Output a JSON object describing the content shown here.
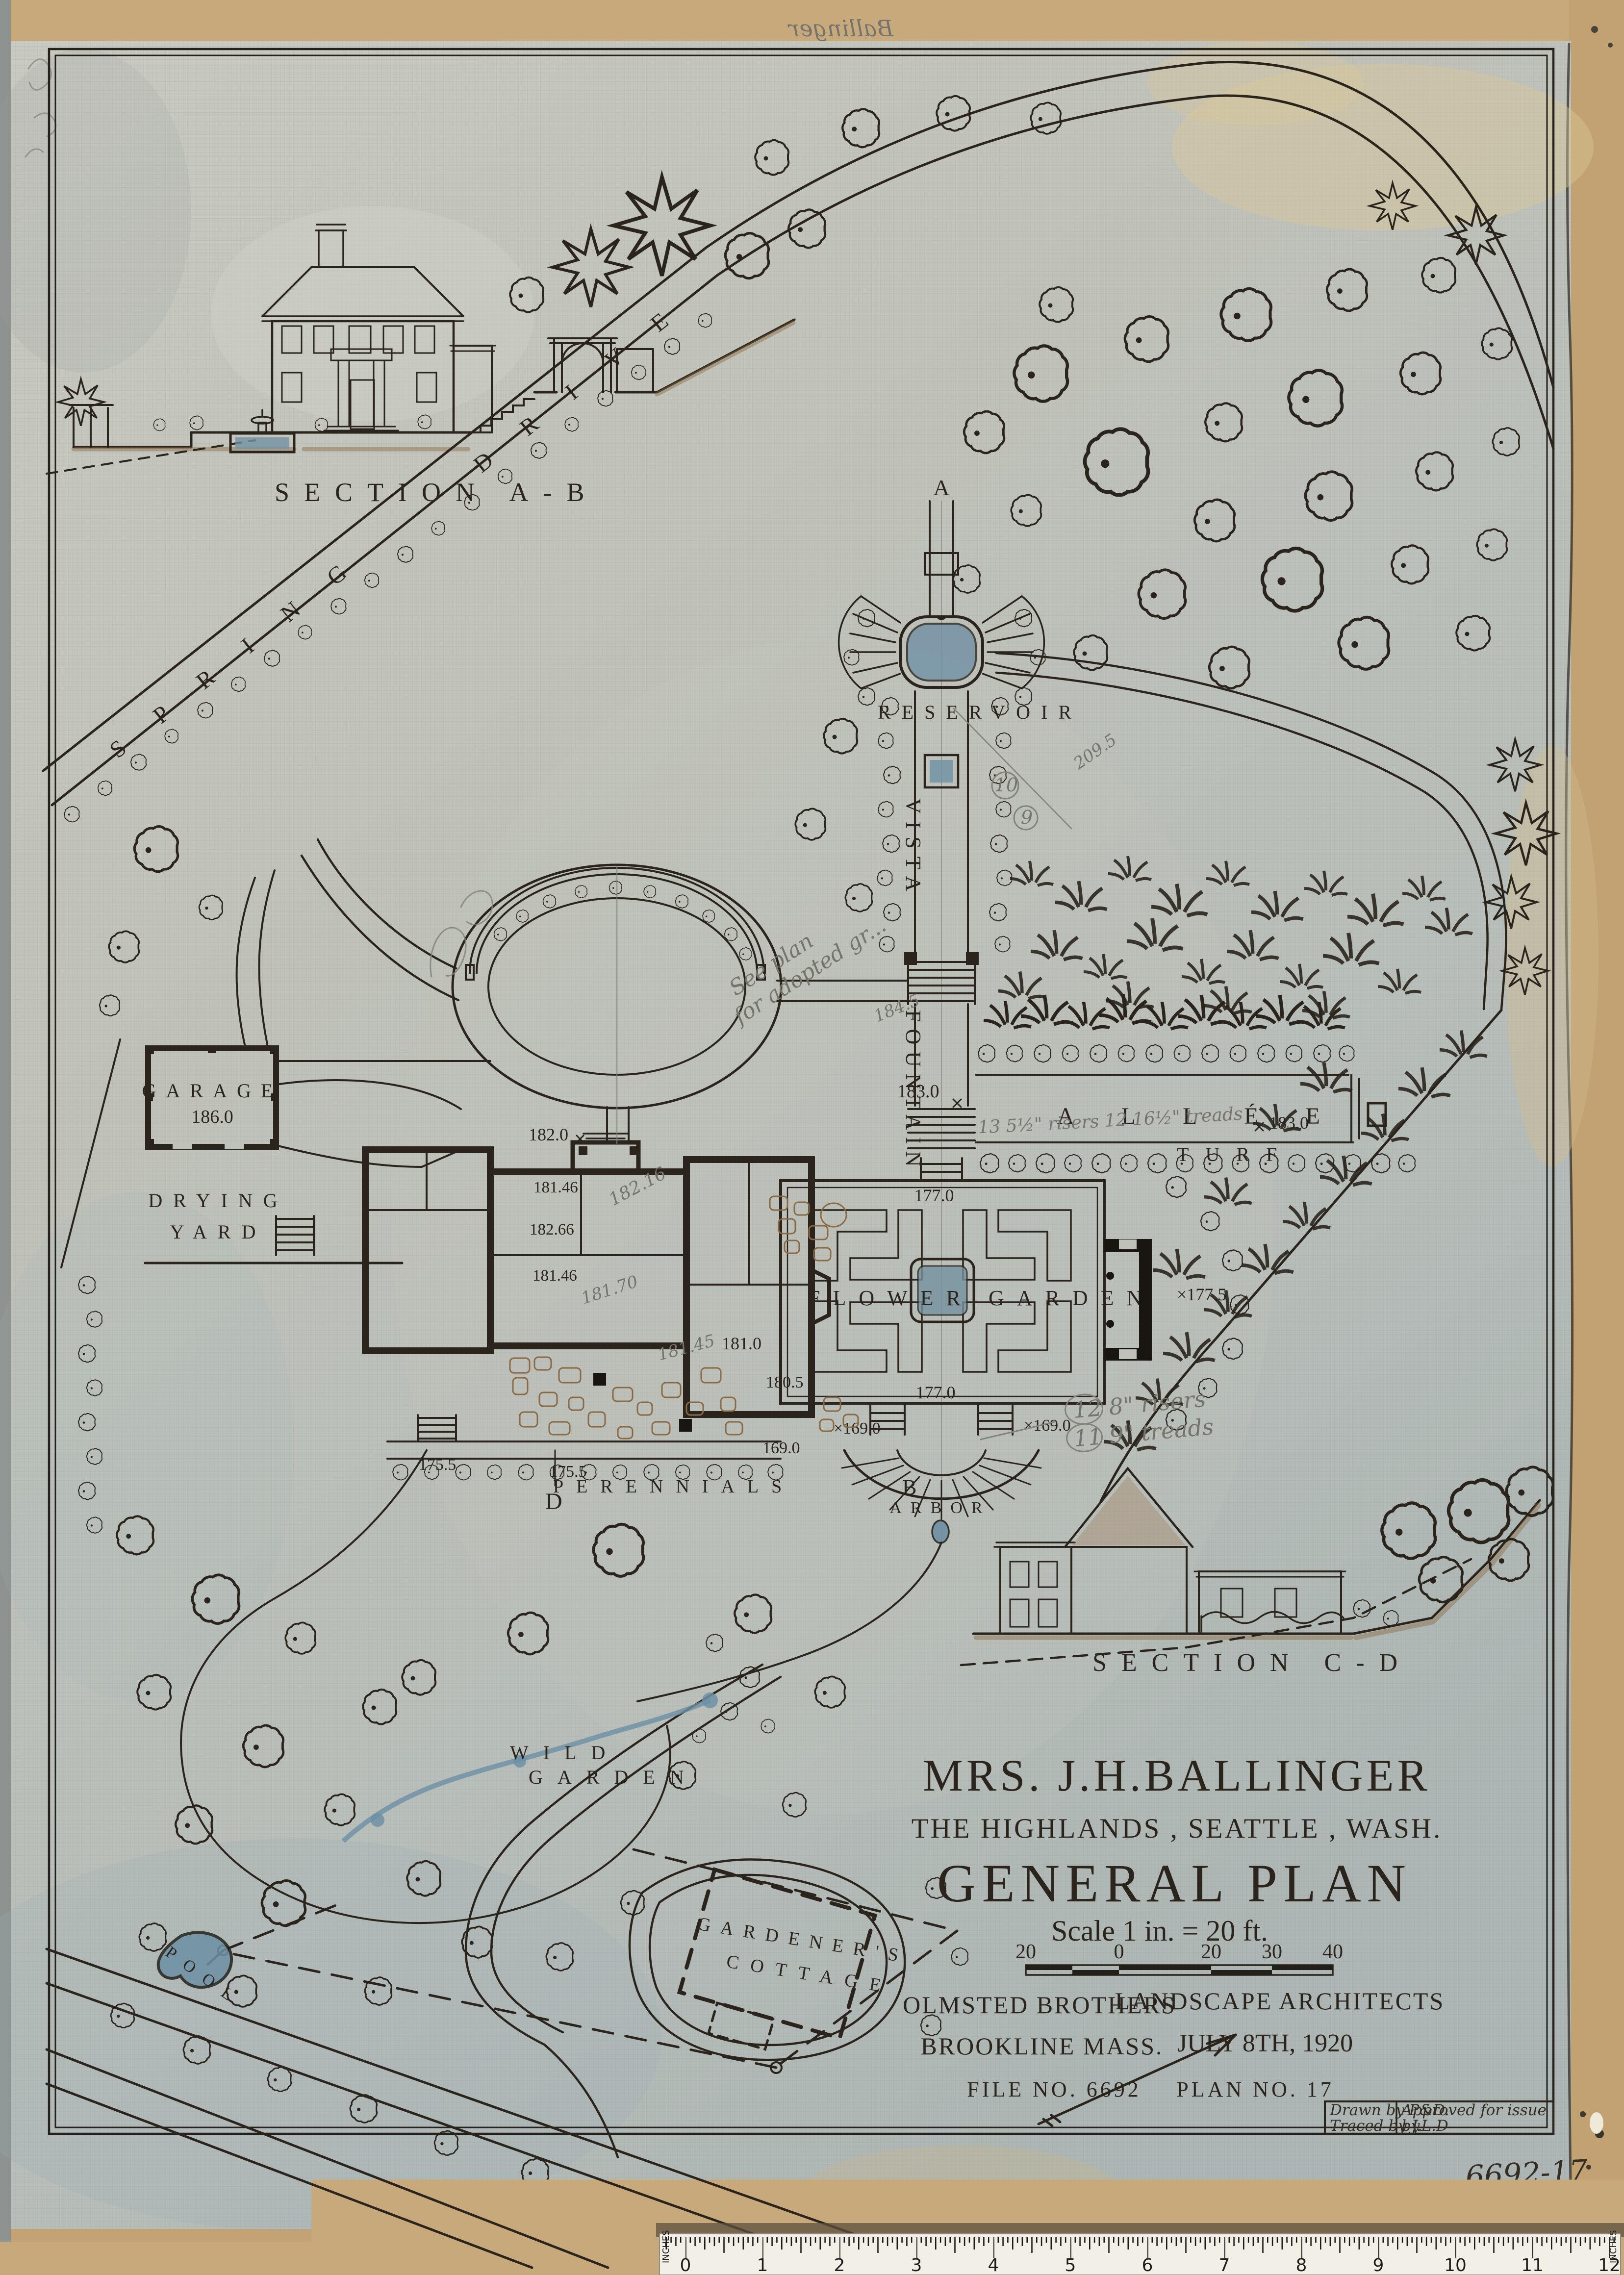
{
  "sheet": {
    "verso_note": "Ballinger",
    "sheet_no": "6692-17",
    "stamp": {
      "drawn_by": "Drawn by P&D.",
      "traced_by": "Traced by J.L.D",
      "approved": "Approved for issue",
      "by": "by."
    },
    "ruler": {
      "units": "INCHES",
      "marks": [
        "0",
        "1",
        "2",
        "3",
        "4",
        "5",
        "6",
        "7",
        "8",
        "9",
        "10",
        "11",
        "12"
      ]
    }
  },
  "title_block": {
    "client": "MRS. J.H.BALLINGER",
    "location": "THE HIGHLANDS , SEATTLE , WASH.",
    "title": "GENERAL PLAN",
    "scale_note": "Scale 1 in. = 20 ft.",
    "scale_bar": [
      "20",
      "0",
      "20",
      "30",
      "40"
    ],
    "firm_line1": "OLMSTED BROTHERS",
    "firm_line2": "BROOKLINE MASS.",
    "firm_line3": "LANDSCAPE ARCHITECTS",
    "date": "JULY 8TH, 1920",
    "file_no": "FILE NO. 6692",
    "plan_no": "PLAN NO. 17"
  },
  "sections": {
    "ab": "SECTION A-B",
    "cd": "SECTION C-D",
    "marker_a": "A",
    "marker_b": "B",
    "marker_d": "D"
  },
  "labels": {
    "spring": "SPRING",
    "drive": "DRIVE",
    "reservoir": "RESERVOIR",
    "vista": "VISTA",
    "fountain": "FOUNTAIN",
    "allee": "ALLÉE",
    "turf": "TURF",
    "flower": "FLOWER",
    "garden": "GARDEN",
    "arbor": "ARBOR",
    "perennials": "PERENNIALS",
    "garage": "GARAGE",
    "drying": "DRYING",
    "yard": "YARD",
    "wild": "WILD",
    "wild_garden": "GARDEN",
    "gardeners": "GARDENER'S",
    "cottage": "COTTAGE",
    "pool": "POOL"
  },
  "elevations": {
    "garage": "186.0",
    "court": "182.0",
    "house_1": "181.46",
    "house_2": "182.66",
    "house_3": "181.46",
    "house_4": "181.0",
    "house_5": "180.5",
    "terrace_w": "175.5",
    "perennials_1": "175.5",
    "axis": "183.0",
    "allee_end": "183.0",
    "fg_top": "177.0",
    "fg_right": "×177.5",
    "fg_bottom": "177.0",
    "t169_a": "169.0",
    "t169_b": "×169.0",
    "t169_c": "×169.0"
  },
  "pencil": {
    "see_plan_1": "See plan",
    "see_plan_2": "for adopted gr...",
    "arbor_note_1": "12  8\" risers",
    "arbor_note_2": "11  9\" treads",
    "allee_note": "13  5½\" risers   12  16½\" treads",
    "g_182_16": "182.16",
    "g_181_70": "181.70",
    "g_181_45": "181.45",
    "g_184_5": "184.5",
    "g_209_5": "209.5",
    "c10": "10",
    "c9": "9"
  }
}
